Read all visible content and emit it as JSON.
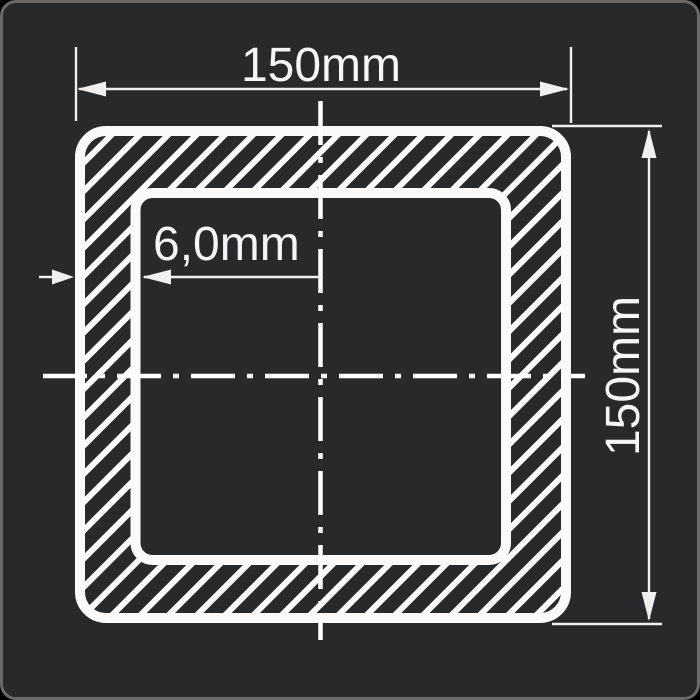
{
  "drawing": {
    "title": "square-hollow-section-cross-section",
    "dimensions": {
      "width_label": "150mm",
      "height_label": "150mm",
      "wall_thickness_label": "6,0mm"
    },
    "colors": {
      "panel_background": "#27292a",
      "panel_border": "#696969",
      "profile_line": "#fafafa",
      "hatch_line": "#fafafa",
      "dimension_line": "#f0f0f0",
      "text": "#f5f5f5"
    }
  }
}
